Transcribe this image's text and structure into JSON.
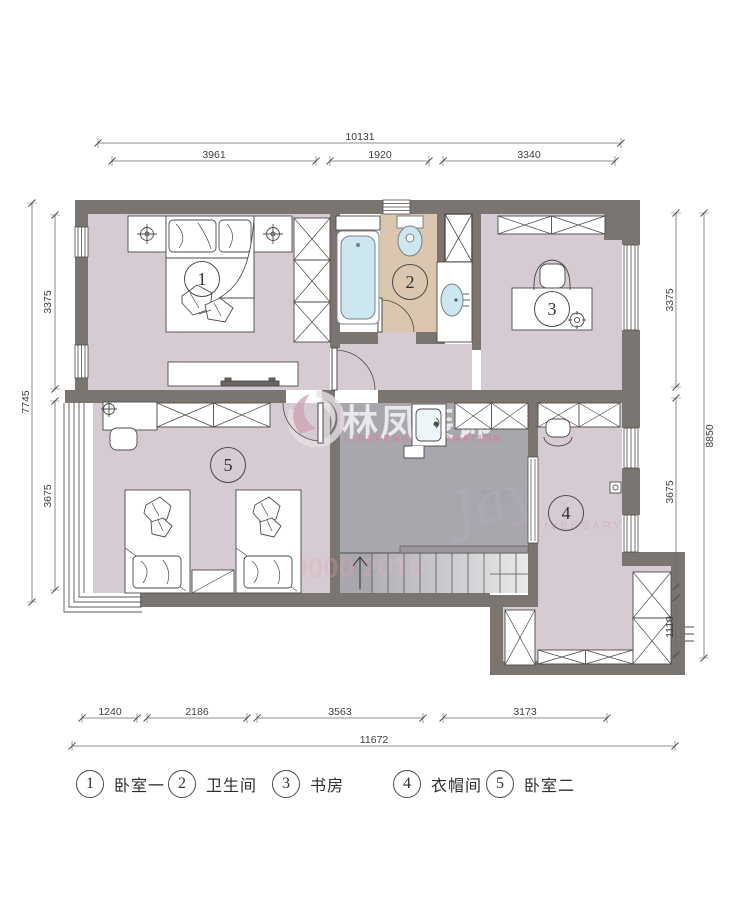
{
  "dims": {
    "top": {
      "total": "10131",
      "segments": [
        "3961",
        "1920",
        "3340"
      ]
    },
    "left": {
      "total": "7745",
      "segments": [
        "3375",
        "3675"
      ]
    },
    "right": {
      "total": "8850",
      "segments": [
        "3375",
        "3675",
        "1110"
      ]
    },
    "bottom": {
      "total": "11672",
      "segments": [
        "1240",
        "2186",
        "3563",
        "3173"
      ]
    }
  },
  "rooms": [
    {
      "num": "1",
      "label": "卧室一"
    },
    {
      "num": "2",
      "label": "卫生间"
    },
    {
      "num": "3",
      "label": "书房"
    },
    {
      "num": "4",
      "label": "衣帽间"
    },
    {
      "num": "5",
      "label": "卧室二"
    }
  ],
  "watermark": {
    "title": "林凤装饰",
    "subtitle": "LIN&FENG DECORATION",
    "script": "Jay",
    "artist": "周杰",
    "anniversary": "ANNIVERSARY",
    "digits": "0000 2010"
  },
  "colors": {
    "wall": "#7b7572",
    "bedroom_floor": "#d6cbd3",
    "bath_floor": "#dbc7b0",
    "hall_floor": "#a8a7ae",
    "fixture_blue": "#cde7f1",
    "watermark_pink": "#d687a0",
    "line": "#4d4a48"
  }
}
